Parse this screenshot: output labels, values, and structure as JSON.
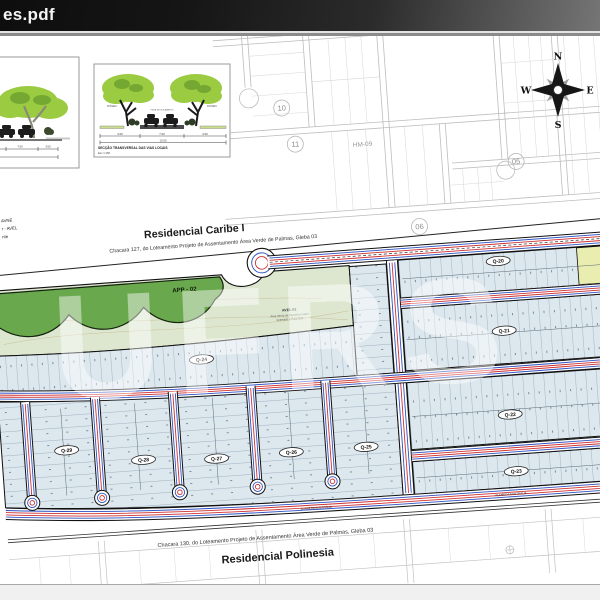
{
  "window": {
    "title": "es.pdf"
  },
  "watermark": {
    "text": "UFRS"
  },
  "diag": {
    "caption1": "SECÇÃO TRANSVERSAL DAS VIAS LOCAIS",
    "caption2": "Esc 1:150",
    "d_left": "3.00",
    "d_mid": "7.00",
    "d_right": "3.00",
    "d_total": "13.00",
    "passeio_l": "PASSEIO",
    "pista": "PISTA DE ROLAMENTO",
    "passeio_r": "PASSEIO",
    "b1_d1": "7.00",
    "b1_d2": "3.00"
  },
  "legend": [
    "AVNE",
    "r - AVEL",
    "nte"
  ],
  "compass": {
    "n": "N",
    "e": "E",
    "s": "S",
    "w": "W"
  },
  "bg": {
    "b10": "10",
    "b11": "11",
    "b05": "05",
    "b06": "06",
    "hm": "HM-09"
  },
  "caribe": {
    "title": "Residencial Caribe I",
    "subtitle": "Chacara 127, do Loteamento Projeto de Assentamento Área Verde de Palmas, Gleba 03"
  },
  "polinesia": {
    "title": "Residencial Polinesia",
    "subtitle": "Chacara 130, do Loteamento Projeto de Assentamento Área Verde de Palmas, Gleba 03"
  },
  "areas": {
    "app": "APP - 02",
    "avel": "AVEL-01",
    "avel1": "Área Verde de Esporte e Lazer",
    "avel2": "Gramado e Para Golf"
  },
  "blocks": {
    "q20": "Q-20",
    "q21": "Q-21",
    "q22": "Q-22",
    "q23": "Q-23",
    "q24": "Q-24",
    "q25": "Q-25",
    "q26": "Q-26",
    "q27": "Q-27",
    "q28": "Q-28",
    "q29": "Q-29"
  },
  "streets": {
    "alameda": "ALAMEDA AUSTRÁLIA"
  },
  "colors": {
    "lot_fill": "#dce7ee",
    "utility_blue": "#2b52c4",
    "utility_red": "#d03030",
    "green_dark": "#6aa84e",
    "green_pale": "#dde7cf",
    "yellow_lot": "#e9edb0",
    "canopy": "#9bcb41",
    "titlebar_dark": "#0e0e0e"
  }
}
